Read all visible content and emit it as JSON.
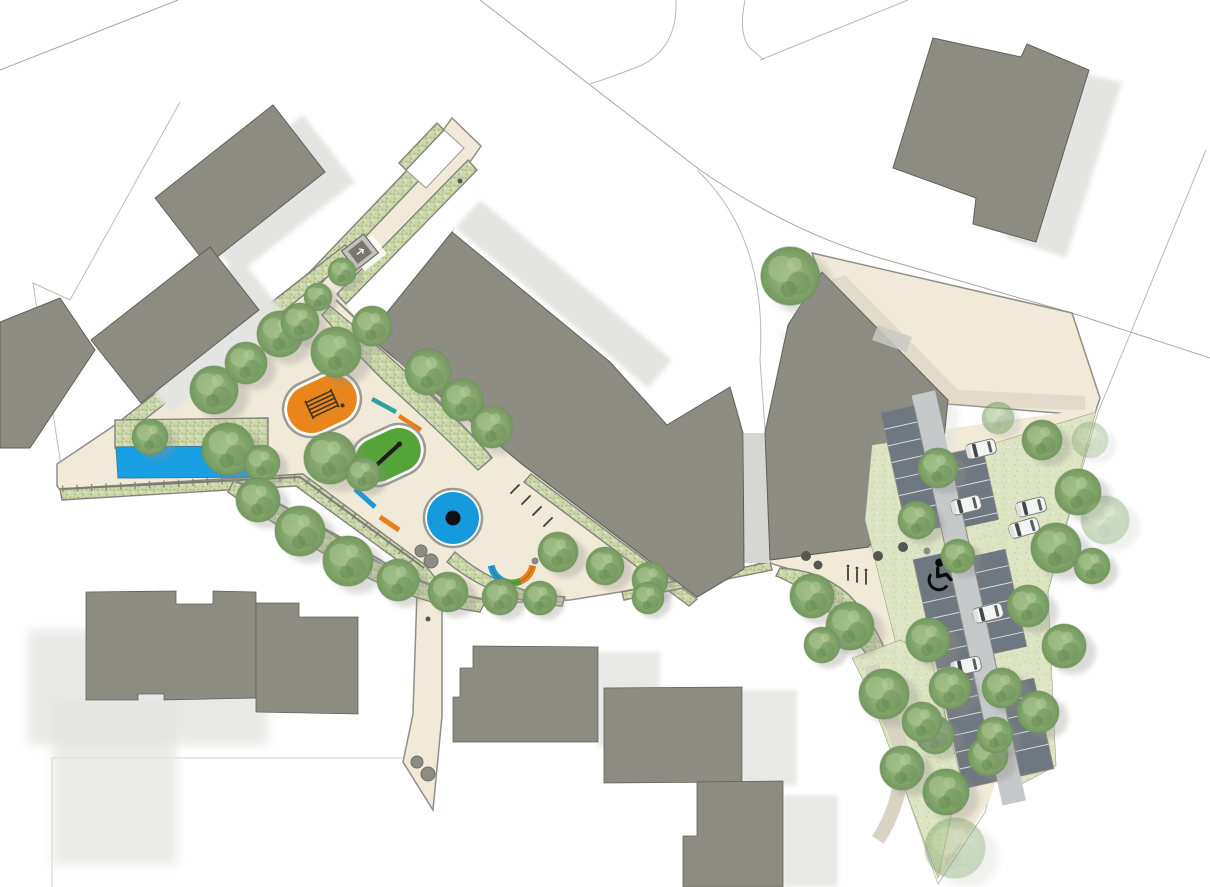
{
  "document": {
    "kind": "landscape-masterplan-site-plan",
    "view": "top-down plan drawing",
    "visible_text": "none"
  },
  "colors": {
    "paving": "#f1ead9",
    "paving_line": "#8f8f88",
    "paving_shade": "#e3dcc6",
    "bed_green": "#ccd7ab",
    "bed_line": "#84847d",
    "grass": "#dde4c3",
    "water": "#189fe4",
    "water_line": "#3a7d9e",
    "building": "#8c8c83",
    "building_line": "#60605a",
    "building_shadow": "#e4e4e2",
    "road_line": "#a6a6a0",
    "play_orange": "#e8861c",
    "play_green": "#55a437",
    "play_blue": "#169ade",
    "beam_teal": "#2ba49b",
    "beam_blue": "#2196d6",
    "beam_orange": "#e87f1a",
    "equipment_outline": "#9a9a93",
    "parking_bay": "#6f7880",
    "parking_aisle": "#c6c9ca",
    "bay_divider": "#d8d9d9",
    "car_body": "#f4f4f2",
    "car_glass": "#434a4e",
    "bollard": "#575751",
    "boulder": "#8c8c85",
    "icon_black": "#0c0c0c",
    "structure_gray": "#c2c2bc"
  },
  "features": {
    "water_feature": {
      "name": "linear-water-channel",
      "shape": "rectangle"
    },
    "play_equipment": [
      {
        "name": "orange-pill-trampoline",
        "fill": "play_orange"
      },
      {
        "name": "green-pill-balance-beam",
        "fill": "play_green"
      },
      {
        "name": "blue-carousel-circle",
        "fill": "play_blue"
      },
      {
        "name": "curved-play-bench",
        "segments": [
          "beam_blue",
          "play_green",
          "beam_orange"
        ]
      },
      {
        "name": "balance-beam-teal"
      },
      {
        "name": "balance-beam-orange-upper"
      },
      {
        "name": "balance-beam-blue-lower"
      },
      {
        "name": "balance-beam-orange-lower"
      }
    ],
    "parking": {
      "car_count": 6,
      "accessible_bays": 1,
      "accessible_icon": "wheelchair-icon",
      "layout": "double-loaded angled aisle"
    },
    "site_furniture": {
      "bollard_count": 5,
      "boulder_pairs": 2,
      "bike_rack_clusters": 2,
      "utility_structure": 1
    },
    "buildings": {
      "existing_gray_blocks": 10,
      "main_slab_building": 1,
      "east_block": 1
    },
    "planting": {
      "street_trees": "many deciduous canopies",
      "planting_beds": "speckled green strips",
      "lawn_areas": "south-east corner"
    }
  }
}
